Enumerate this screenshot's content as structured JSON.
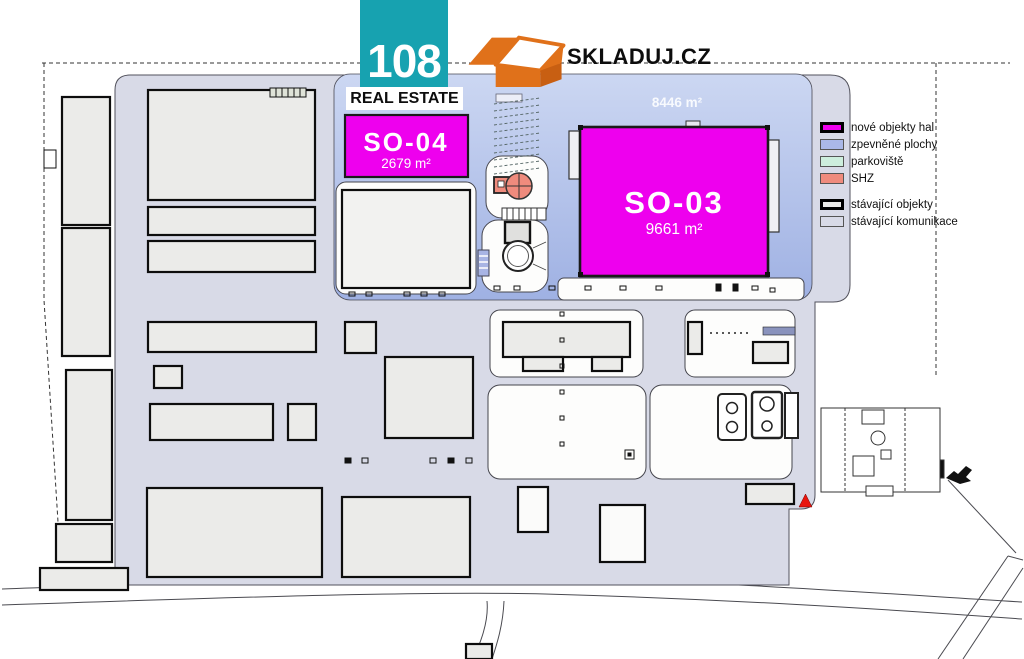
{
  "branding": {
    "number": "108",
    "subtitle": "REAL ESTATE",
    "partner": "SKLADUJ.CZ"
  },
  "halls": {
    "so04": {
      "name": "SO-04",
      "area": "2679 m²"
    },
    "so03": {
      "name": "SO-03",
      "area": "9661 m²"
    },
    "paved_area_label": "8446 m²"
  },
  "legend": {
    "items": [
      {
        "label": "nové objekty hal",
        "color": "#ee00ee",
        "border": "thick"
      },
      {
        "label": "zpevněné plochy",
        "color": "#aab8e8",
        "border": "thin"
      },
      {
        "label": "parkoviště",
        "color": "#cdeedd",
        "border": "thin"
      },
      {
        "label": "SHZ",
        "color": "#ef8b7d",
        "border": "thin"
      },
      {
        "label": "stávající objekty",
        "color": "#ebebe9",
        "border": "thick"
      },
      {
        "label": "stávající komunikace",
        "color": "#d8dae7",
        "border": "thin"
      }
    ]
  },
  "colors": {
    "brand_teal": "#17a2b0",
    "brand_orange": "#e0711a",
    "hall_magenta": "#ee00ee",
    "paved_blue": "#aab8e8",
    "roads_lavender": "#d8dae7",
    "existing_gray": "#ebebe9",
    "shz_salmon": "#ef8b7d",
    "marker_red": "#e8150e"
  }
}
